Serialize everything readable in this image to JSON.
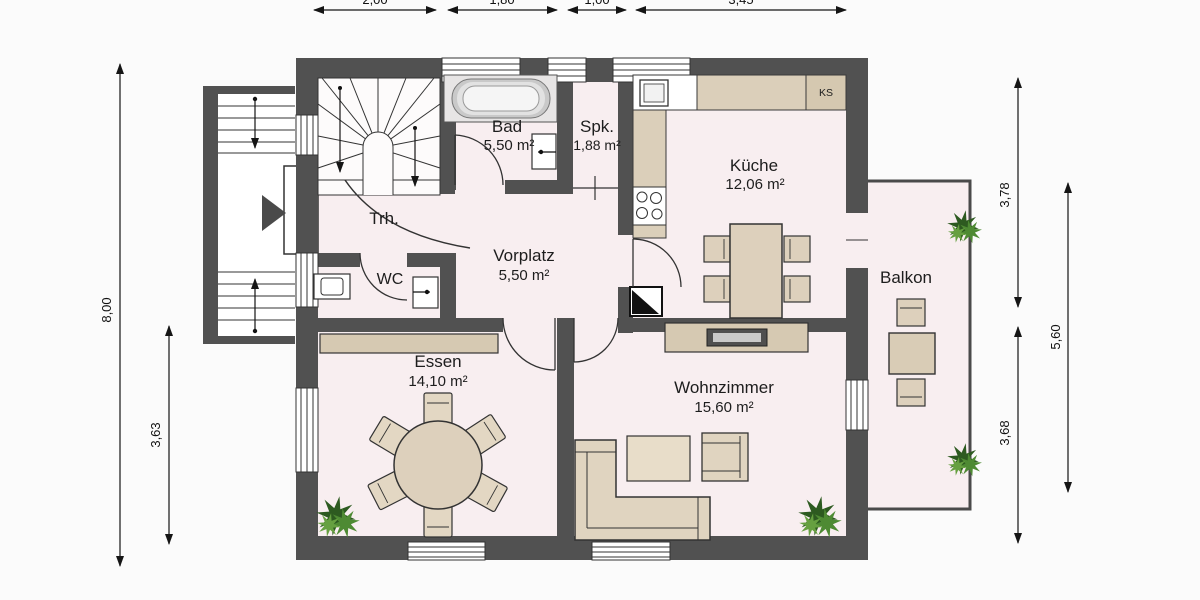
{
  "plan": {
    "rooms": {
      "bad": {
        "name": "Bad",
        "area": "5,50 m²"
      },
      "spk": {
        "name": "Spk.",
        "area": "1,88 m²"
      },
      "kueche": {
        "name": "Küche",
        "area": "12,06 m²"
      },
      "trh": {
        "name": "Trh."
      },
      "vorplatz": {
        "name": "Vorplatz",
        "area": "5,50 m²"
      },
      "wc": {
        "name": "WC"
      },
      "essen": {
        "name": "Essen",
        "area": "14,10 m²"
      },
      "wohnzimmer": {
        "name": "Wohnzimmer",
        "area": "15,60 m²"
      },
      "balkon": {
        "name": "Balkon"
      }
    },
    "appliances": {
      "ks": "KS"
    },
    "dimensions": {
      "left_total": "8,00",
      "left_lower": "3,63",
      "right_upper": "3,78",
      "right_outer": "5,60",
      "right_lower": "3,68",
      "top": {
        "d1": "2,00",
        "d2": "1,80",
        "d3": "1,00",
        "d4": "3,45"
      }
    },
    "colors": {
      "wall": "#515151",
      "floor": "#f8eef0",
      "furniture": "#ddd0bc",
      "plant": "#4e8a33"
    }
  }
}
